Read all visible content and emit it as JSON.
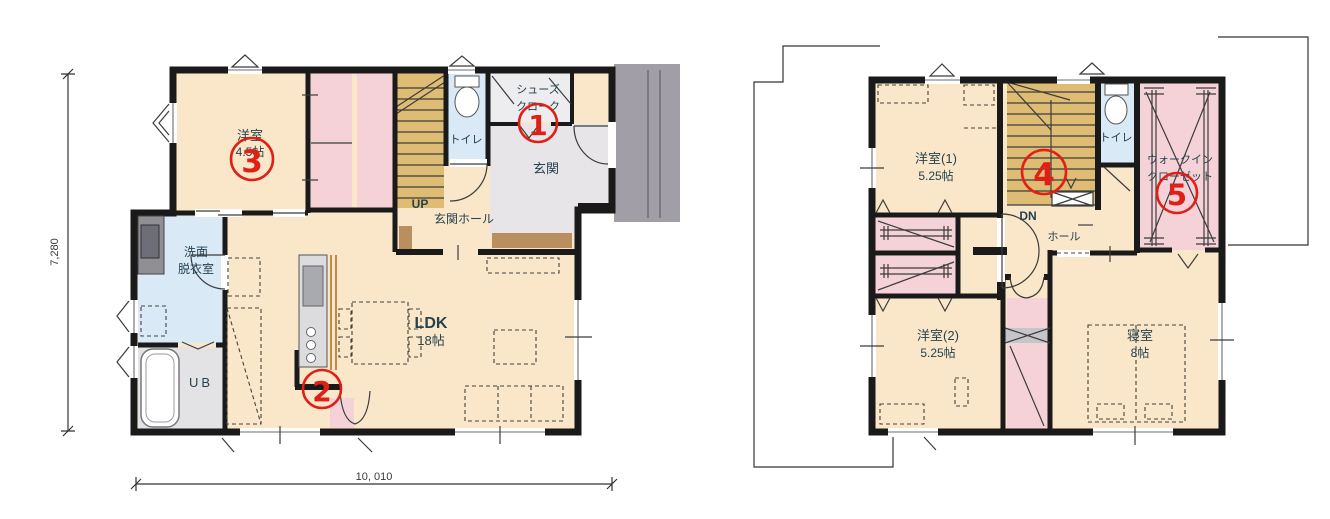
{
  "floor1": {
    "rooms": {
      "youshitsu_name": "洋室",
      "youshitsu_size": "4.5帖",
      "toilet": "トイレ",
      "shoes_closet_line1": "シューズ",
      "shoes_closet_line2": "クローク",
      "genkan": "玄関",
      "genkan_hall": "玄関ホール",
      "stairs_up": "UP",
      "senmen_line1": "洗面",
      "senmen_line2": "脱衣室",
      "unit_bath": "UB",
      "ldk_name": "LDK",
      "ldk_size": "18帖"
    },
    "dimensions": {
      "vertical": "7,280",
      "horizontal": "10, 010"
    }
  },
  "floor2": {
    "rooms": {
      "youshitsu1_name": "洋室(1)",
      "youshitsu1_size": "5.25帖",
      "youshitsu2_name": "洋室(2)",
      "youshitsu2_size": "5.25帖",
      "bedroom_name": "寝室",
      "bedroom_size": "8帖",
      "toilet": "トイレ",
      "hall": "ホール",
      "stairs_down": "DN",
      "wic_line1": "ウォークイン",
      "wic_line2": "クローゼット"
    }
  },
  "markers": {
    "m1": "1",
    "m2": "2",
    "m3": "3",
    "m4": "4",
    "m5": "5"
  },
  "colors": {
    "c-wall": "#1a1a1a",
    "c-cream": "#fae6c8",
    "c-pink": "#f5d2d7",
    "c-blue": "#d9e9f6",
    "c-tan": "#dfbc74",
    "c-tile": "#e7e5e8",
    "c-porch": "#a29ea7",
    "c-bath": "#e3e2e5",
    "c-cloak": "#edecef",
    "c-step": "#b98f60",
    "c-counter": "#dcdcde",
    "c-red": "#e01f17",
    "c-label": "#25424e",
    "c-dim": "#3a3a3a",
    "c-wood": "#b5742a"
  }
}
